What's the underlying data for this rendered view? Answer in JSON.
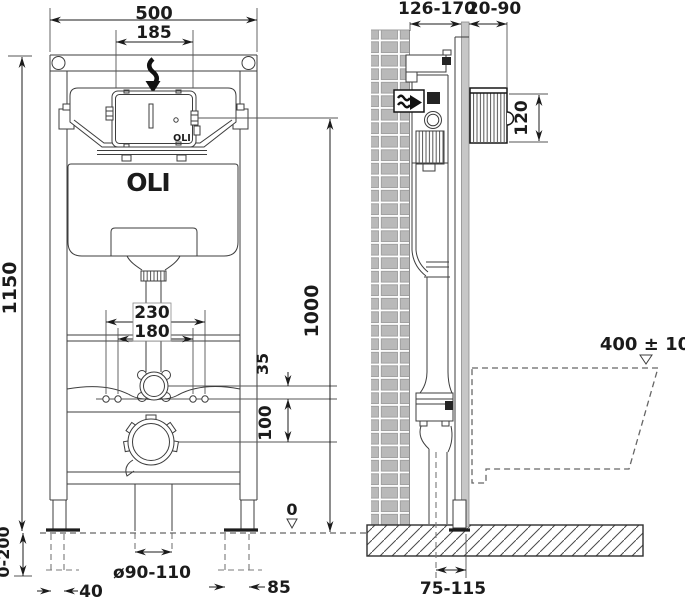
{
  "brand": {
    "logo": "OLI",
    "logo_small": "OLI"
  },
  "front_view": {
    "dim_width_frame": "500",
    "dim_width_access_box": "185",
    "dim_height_frame": "1150",
    "dim_height_outlet_ref": "1000",
    "dim_bolt_spacing_outer": "230",
    "dim_bolt_spacing_inner": "180",
    "dim_flush_bend_offset": "35",
    "dim_drain_offset": "100",
    "dim_leg_adjustment": "0-200",
    "dim_foot_offset_left": "40",
    "dim_drain_diameter": "ø90-110",
    "dim_foot_offset_right": "85",
    "floor_datum": "0"
  },
  "side_view": {
    "dim_depth_frame": "126-170",
    "dim_wall_finish": "20-90",
    "dim_flush_plate_height": "120",
    "dim_bowl_height": "400 ± 10",
    "dim_drain_distance": "75-115"
  }
}
